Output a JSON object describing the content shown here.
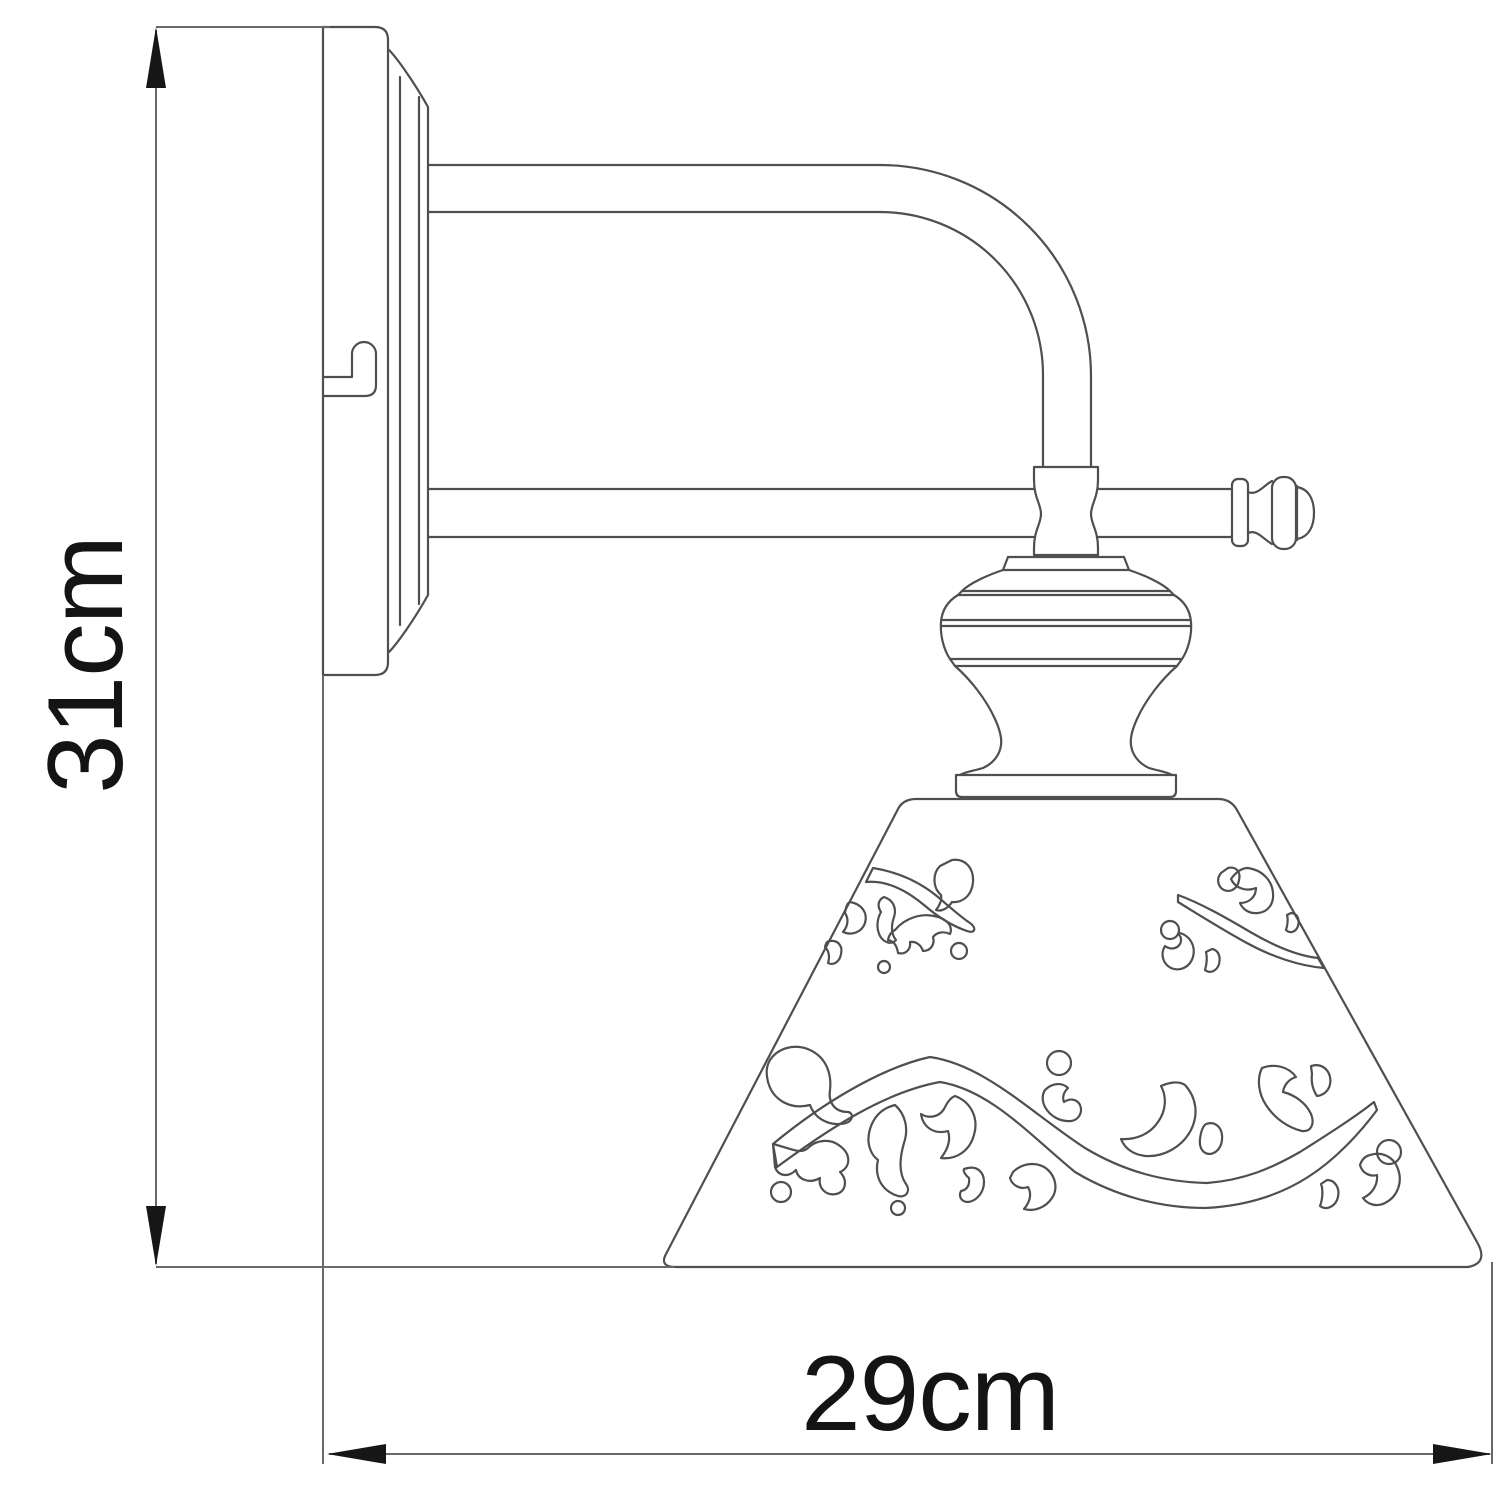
{
  "diagram": {
    "kind": "product dimension drawing",
    "subject": "wall sconce with ornamental cone shade, side view",
    "background_color": "#ffffff",
    "outline_color": "#4f4f4f",
    "dimension_line_color": "#686868",
    "arrow_color": "#161616",
    "text_color": "#141414",
    "dimensions": {
      "height": {
        "label": "31cm",
        "value": 31,
        "unit": "cm",
        "axis": "vertical"
      },
      "width": {
        "label": "29cm",
        "value": 29,
        "unit": "cm",
        "axis": "horizontal"
      }
    }
  }
}
